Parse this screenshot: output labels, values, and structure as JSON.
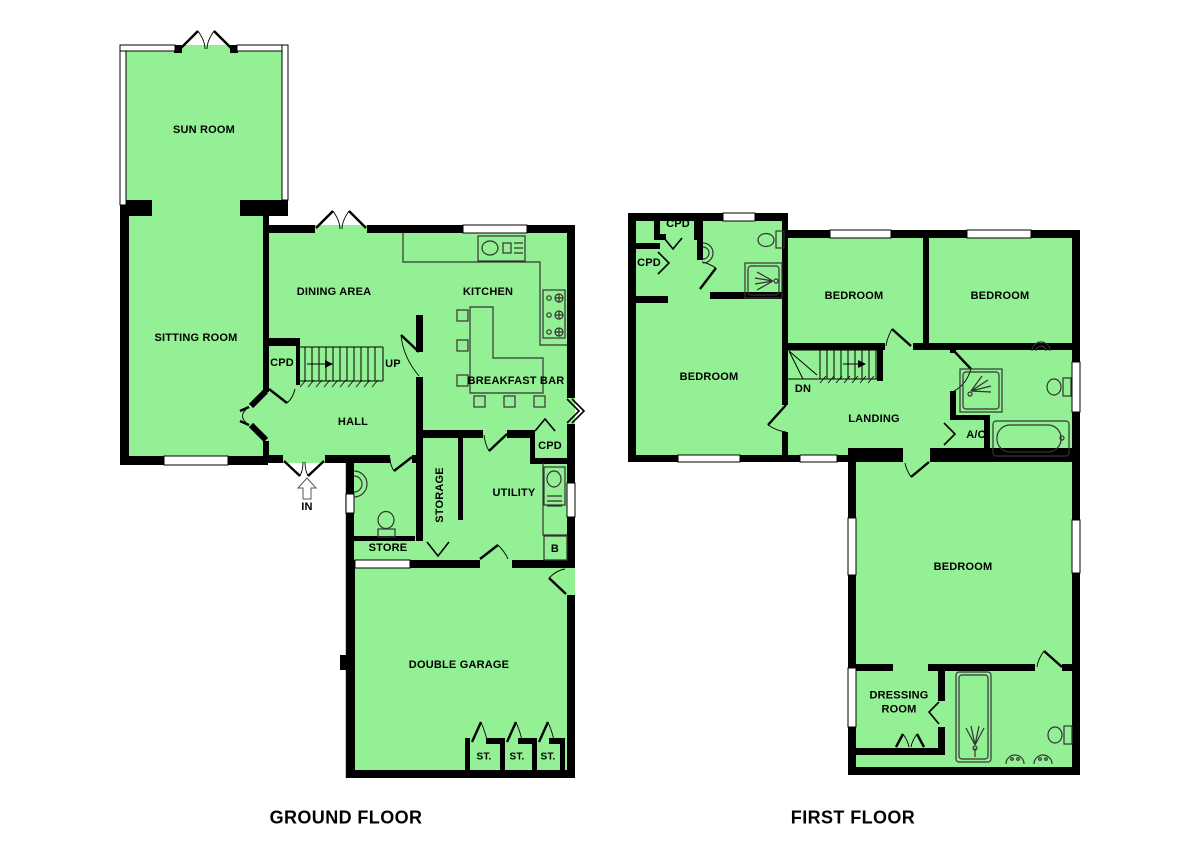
{
  "colors": {
    "room_fill": "#94F094",
    "wall": "#000000",
    "background": "#FFFFFF",
    "fixture_line": "#333333"
  },
  "ground_floor": {
    "title": "GROUND FLOOR",
    "labels": {
      "sun_room": "SUN ROOM",
      "sitting_room": "SITTING ROOM",
      "dining_area": "DINING AREA",
      "kitchen": "KITCHEN",
      "breakfast_bar": "BREAKFAST BAR",
      "cpd_stairs": "CPD",
      "up": "UP",
      "hall": "HALL",
      "entrance_in": "IN",
      "storage": "STORAGE",
      "utility": "UTILITY",
      "cpd_utility": "CPD",
      "boiler": "B",
      "store": "STORE",
      "double_garage": "DOUBLE GARAGE",
      "st_1": "ST.",
      "st_2": "ST.",
      "st_3": "ST."
    }
  },
  "first_floor": {
    "title": "FIRST FLOOR",
    "labels": {
      "cpd_top": "CPD",
      "cpd_left": "CPD",
      "bedroom_left": "BEDROOM",
      "bedroom_mid": "BEDROOM",
      "bedroom_right": "BEDROOM",
      "dn": "DN",
      "landing": "LANDING",
      "airing_cupboard": "A/C",
      "bedroom_master": "BEDROOM",
      "dressing_room": "DRESSING ROOM"
    }
  }
}
